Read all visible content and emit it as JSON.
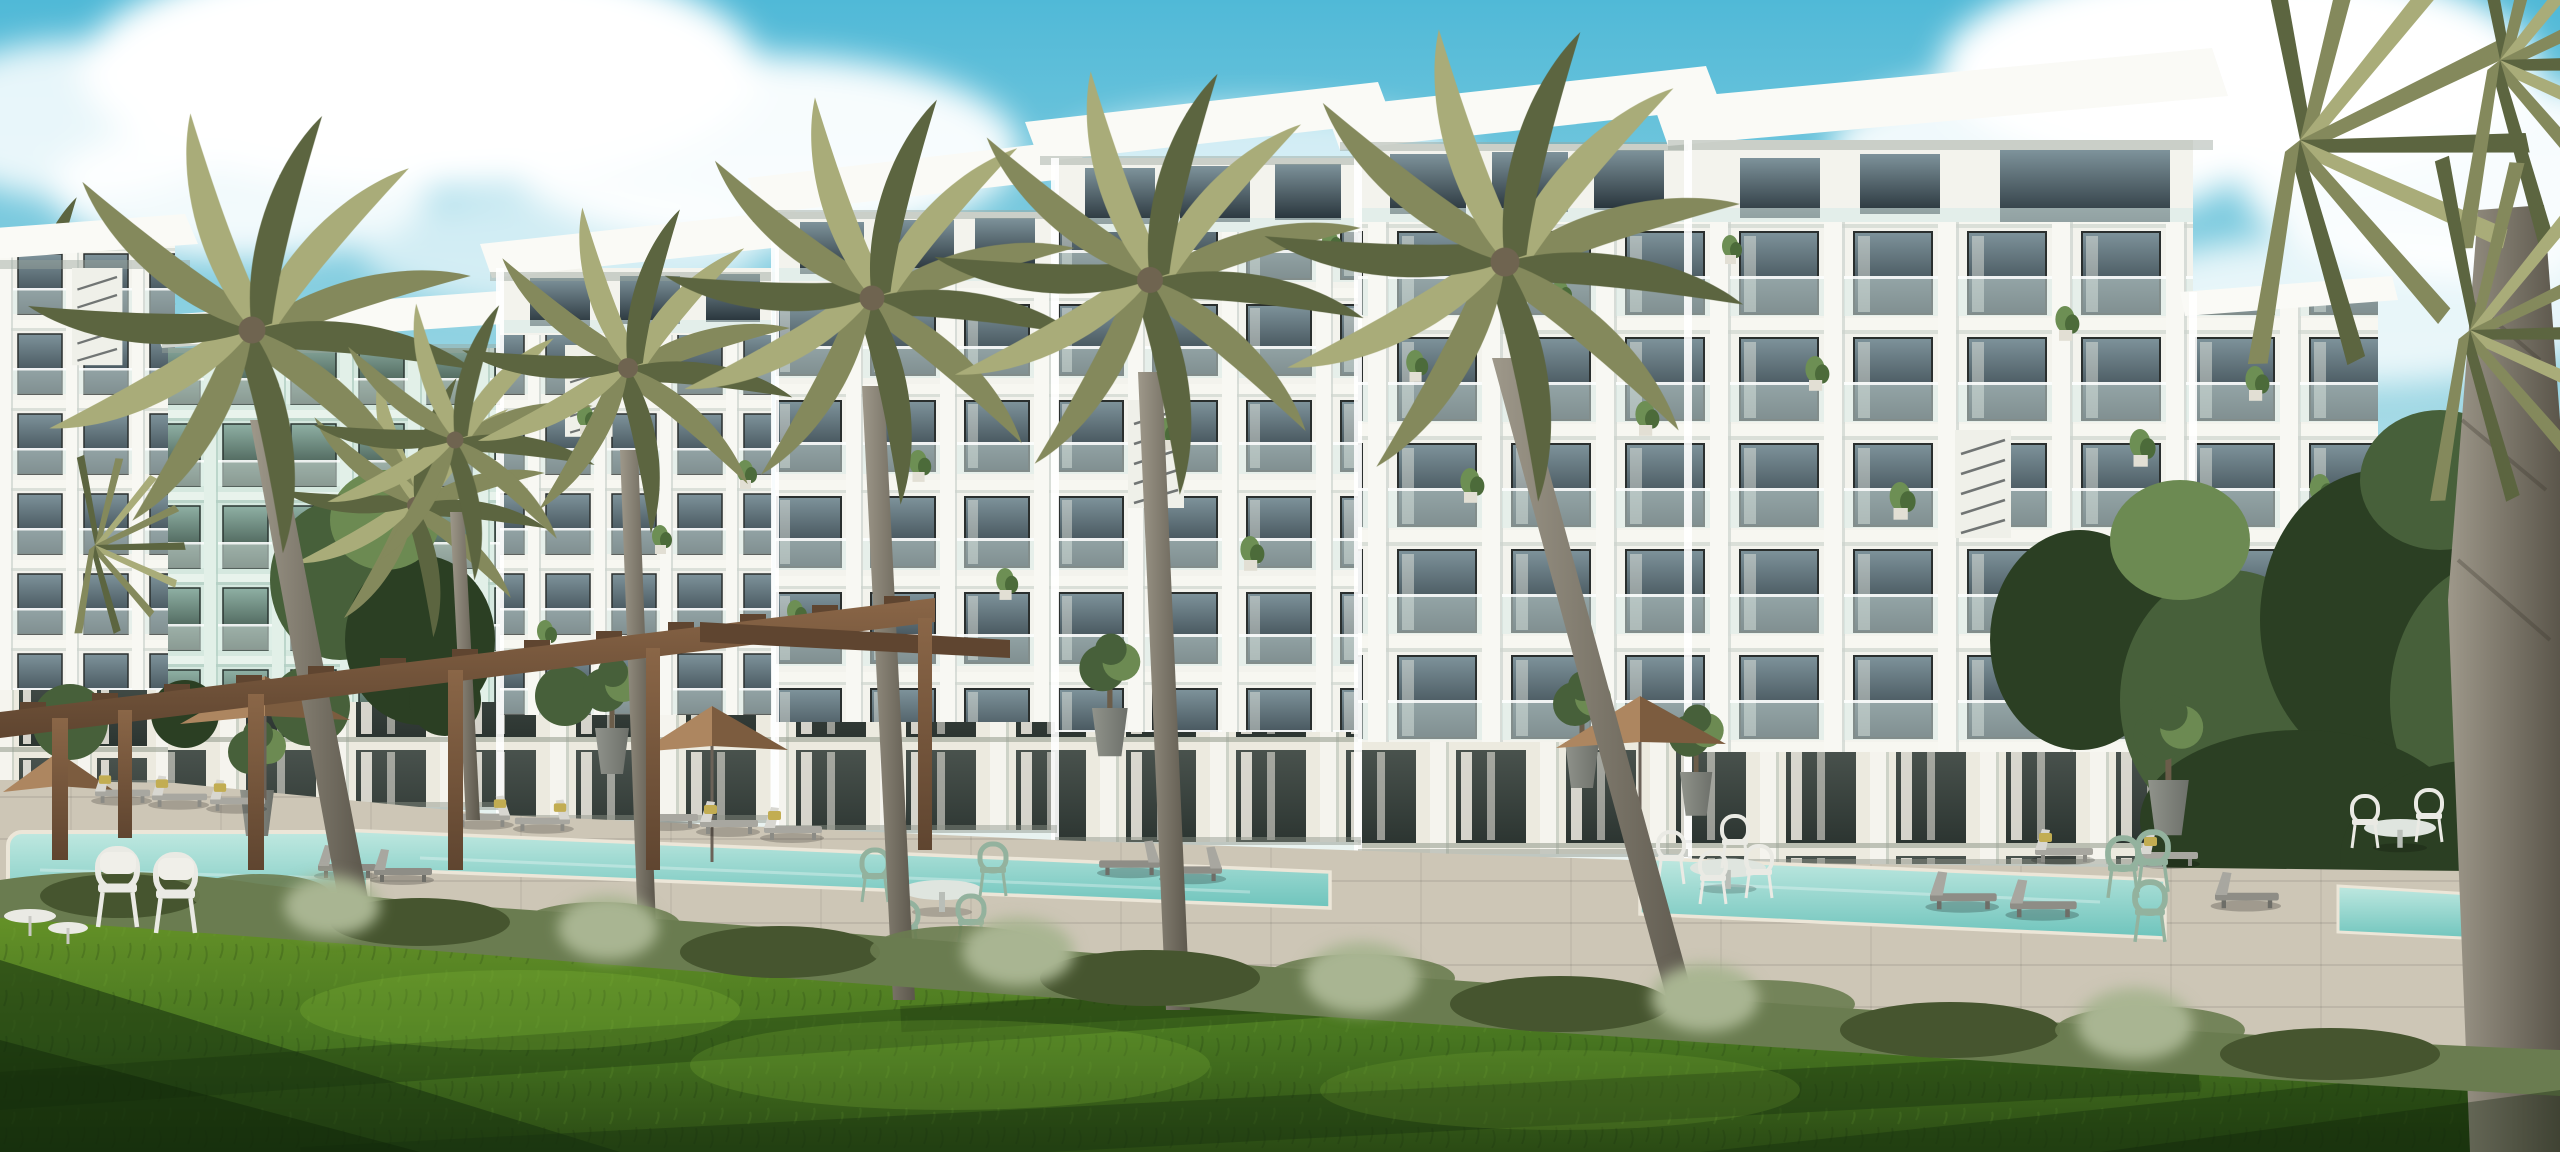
{
  "scene": {
    "description": "Daytime architectural rendering of a modern white tropical resort apartment complex: stepped five-storey blocks with cantilevered flat roofs, grid balconies with glass railings and potted plants, tall palm trees, lagoon-style turquoise pools, sun loungers with yellow pillows, tan parasols, a timber pergola, stone tree planters, a low hedge and a wide sunlit lawn under a partly cloudy cyan sky.",
    "time_of_day": "day",
    "weather": "sunny with scattered clouds",
    "objects": {
      "apartment_building_modules": 7,
      "foreground_palm_trees": 8,
      "fan_palms_right": 3,
      "swimming_pools": 4,
      "parasols": 4,
      "sun_loungers": 15,
      "pergola": 1,
      "pergola_posts": 6,
      "green_bistro_chairs": 6,
      "white_wire_chairs": 8,
      "lawn_armchairs": 2,
      "tree_planters": 7,
      "balcony_plants": 24,
      "staircases": 3,
      "silver_bushes": 6,
      "hedge_rows": 1,
      "lawn": 1
    }
  },
  "palette": {
    "sky_top": "#50b9d7",
    "sky_mid": "#8fd2e2",
    "sky_low": "#d8ecee",
    "sky_horizon": "#ecf4f1",
    "cloud_white": "#ffffff",
    "building_white": "#f3f3ed",
    "building_shadow": "#c9d3cc",
    "building_mint": "#d5e8df",
    "ground_wall": "#eceadf",
    "roof_white": "#fafaf6",
    "roof_underside": "#9aa39b",
    "glass_top": "#7e939b",
    "glass_bottom": "#27333a",
    "glass_mint_top": "#8fb0a4",
    "glass_mint_bottom": "#2c3f36",
    "door_glass_top": "#49524d",
    "door_glass_bottom": "#2c3531",
    "window_frame": "#2a2f2e",
    "rail_glass": "#d9ebe8",
    "curtain": "#f1efe6",
    "palm_light": "#a9ac79",
    "palm_mid": "#84895c",
    "palm_dark": "#5c6540",
    "trunk_light": "#9e988a",
    "trunk_dark": "#5b564b",
    "tree_green": "#47603a",
    "tree_dark": "#2b3f23",
    "tree_light": "#6c8a52",
    "bush_silver": "#a9b592",
    "hedge_green": "#6a7c50",
    "hedge_dark": "#46552f",
    "lawn_light": "#679428",
    "lawn_mid": "#477520",
    "lawn_dark": "#2a4a14",
    "lawn_shadow": "#16300e",
    "lawn_sun": "#8cc23d",
    "pool_light": "#bfe8e0",
    "pool_deep": "#6ec4bc",
    "pool_coping": "#ece6d8",
    "deck_paving": "#cdc6b6",
    "deck_shadow": "#8d9288",
    "umbrella_lit": "#ad8660",
    "umbrella_shade": "#7c5c3f",
    "wood": "#8a6647",
    "wood_dark": "#5f4530",
    "lounger_light": "#d8d7d1",
    "lounger_gray": "#a8a7a0",
    "lounger_dark": "#8e8d86",
    "pillow_yellow": "#c2ad52",
    "chair_green": "#93b29e",
    "chair_white": "#eaeae4",
    "table_top": "#dfe5df",
    "pot_stone": "#90938b",
    "pot_dark": "#6d706a",
    "pot_trunk": "#6b5d4a"
  }
}
